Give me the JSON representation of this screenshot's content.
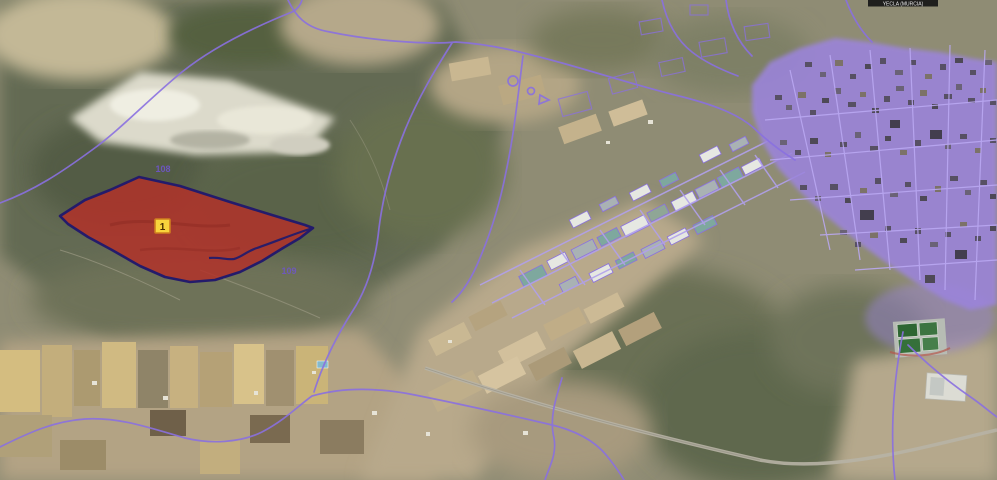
{
  "map": {
    "title_label": "YECLA (MURCIA)",
    "selected_parcel": {
      "marker": "1"
    },
    "polygon_labels": {
      "north": "108",
      "south": "109"
    },
    "colors": {
      "parcel_fill": "#b23129",
      "parcel_border": "#241b6b",
      "cadastral_line": "#8a70e0",
      "street_line": "#b1a0ec",
      "urban_fill": "#9b84dc",
      "marker_bg": "#f8d43c",
      "marker_border": "#cf7f1f",
      "marker_text": "#4a3000",
      "label_text": "#6f55cc",
      "title_bar_bg": "#161616",
      "title_bar_text": "#e8e8e8"
    }
  }
}
